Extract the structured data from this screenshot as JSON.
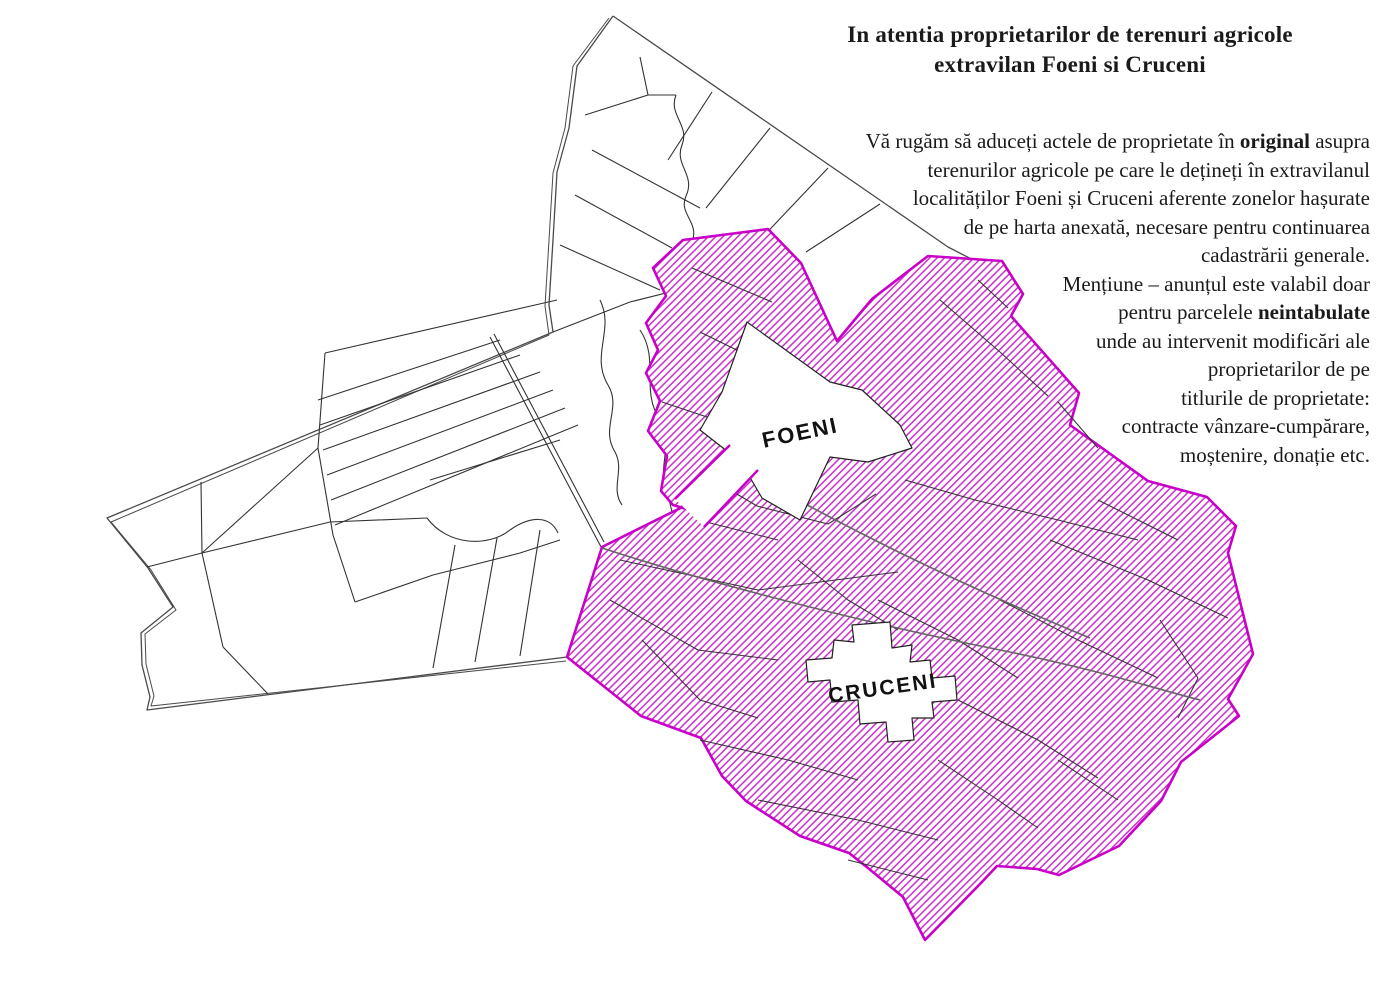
{
  "announcement": {
    "title_lines": [
      "In atentia proprietarilor de terenuri agricole",
      "extravilan Foeni si Cruceni"
    ],
    "body_lines": [
      [
        {
          "t": "Vă rugăm să aduceți actele de proprietate în ",
          "b": false
        },
        {
          "t": "original",
          "b": true
        },
        {
          "t": " asupra",
          "b": false
        }
      ],
      [
        {
          "t": "terenurilor agricole pe care le dețineți în extravilanul",
          "b": false
        }
      ],
      [
        {
          "t": "localităților Foeni și Cruceni aferente zonelor hașurate",
          "b": false
        }
      ],
      [
        {
          "t": "de pe harta anexată, necesare pentru continuarea",
          "b": false
        }
      ],
      [
        {
          "t": "cadastrării generale.",
          "b": false
        }
      ],
      [
        {
          "t": "Mențiune – anunțul este valabil doar",
          "b": false
        }
      ],
      [
        {
          "t": "pentru parcelele ",
          "b": false
        },
        {
          "t": "neintabulate",
          "b": true
        }
      ],
      [
        {
          "t": "unde au intervenit modificări ale",
          "b": false
        }
      ],
      [
        {
          "t": "proprietarilor de pe",
          "b": false
        }
      ],
      [
        {
          "t": "titlurile de proprietate:",
          "b": false
        }
      ],
      [
        {
          "t": "contracte vânzare-cumpărare,",
          "b": false
        }
      ],
      [
        {
          "t": "moștenire, donație etc.",
          "b": false
        }
      ]
    ]
  },
  "map": {
    "labels": {
      "foeni": "FOENI",
      "cruceni": "CRUCENI"
    },
    "colors": {
      "hatch": "#cb2fcb",
      "hatch_border": "#c800c8",
      "parcel_line": "#333333",
      "boundary_line": "#4a4a4a",
      "road_line": "#666666",
      "background": "#ffffff"
    }
  }
}
